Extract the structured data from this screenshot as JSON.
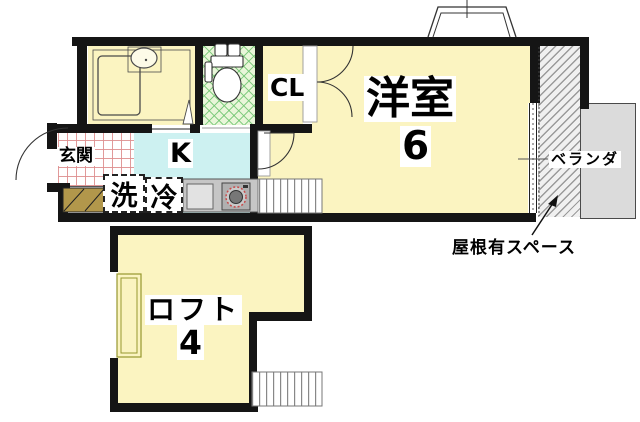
{
  "plan": {
    "labels": {
      "western_room": "洋室",
      "western_room_size": "6",
      "loft": "ロフト",
      "loft_size": "4",
      "kitchen": "K",
      "entrance": "玄関",
      "closet": "CL",
      "veranda": "ベランダ",
      "roofed_space": "屋根有スペース",
      "washer": "洗",
      "refrigerator": "冷"
    },
    "colors": {
      "wall": "#151515",
      "room_fill": "#FBF4C1",
      "kitchen_fill": "#CDF1F1",
      "toilet_fill": "#E9F6D9",
      "toilet_lattice": "#74C674",
      "entrance_grid": "#DE8F8F",
      "veranda_fill": "#DBDBDB",
      "hatch_line": "#9A9A9A",
      "shoe_cabinet_fill": "#B2974B",
      "stove_accent": "#C84B4B"
    }
  }
}
